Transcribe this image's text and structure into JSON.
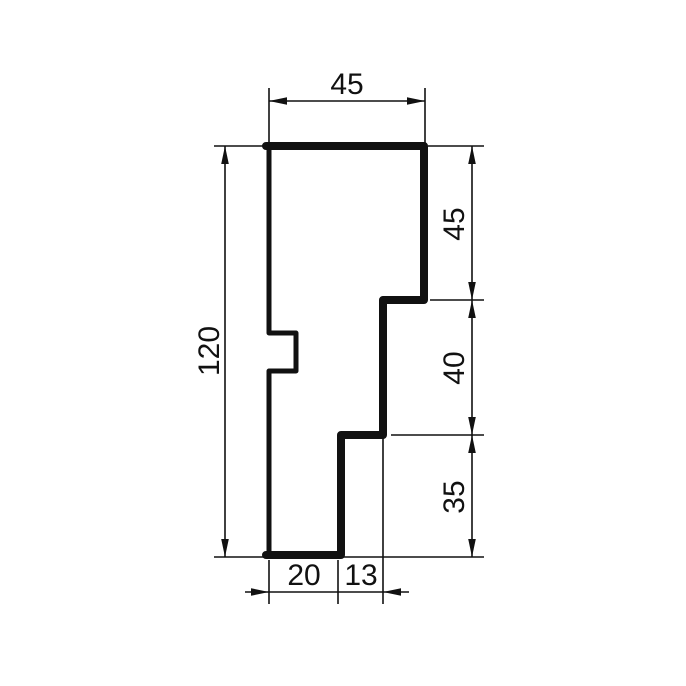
{
  "colors": {
    "line": "#111111",
    "background": "#ffffff"
  },
  "drawing": {
    "kind": "profile-cross-section-dimension-drawing"
  },
  "dimensions": {
    "top_width": "45",
    "side_upper": "45",
    "side_middle": "40",
    "side_lower": "35",
    "total_height": "120",
    "bottom_left": "20",
    "bottom_right": "13"
  }
}
